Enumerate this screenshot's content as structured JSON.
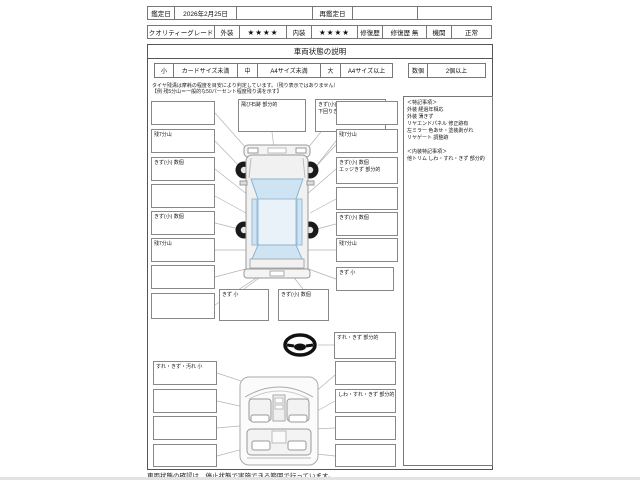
{
  "header": {
    "appraisal_date_label": "鑑定日",
    "appraisal_date": "2026年2月25日",
    "mid_blank": "",
    "reappraisal_date_label": "再鑑定日",
    "reappraisal_date": "",
    "end_blank": "",
    "quality_grade_label": "クオリティーグレード",
    "exterior_label": "外装",
    "exterior_stars": "★★★★",
    "interior_label": "内装",
    "interior_stars": "★★★★",
    "repair_history_label": "修復歴",
    "repair_history_value": "修復歴 無",
    "engine_label": "機関",
    "engine_value": "正常"
  },
  "panel": {
    "title": "車両状態の説明",
    "legend": {
      "small_key": "小",
      "small_val": "カードサイズ未満",
      "medium_key": "中",
      "medium_val": "A4サイズ未満",
      "large_key": "大",
      "large_val": "A4サイズ以上",
      "count_key": "数個",
      "count_val": "2個以上"
    },
    "tire_note_line1": "タイヤ残溝は摩耗の程度を目安により判定しています。（残り表示ではありません）",
    "tire_note_line2": "【例 残5分山＝一般的な50パーセント程度残り溝を示す】"
  },
  "exterior": {
    "left_boxes": [
      "",
      "残7分山",
      "きず(小) 数個",
      "",
      "きず(小) 数個",
      "残7分山",
      "",
      ""
    ],
    "top_boxes": [
      {
        "line1": "飛び石跡 部分的",
        "line2": ""
      },
      {
        "line1": "きず(小) 数個",
        "line2": "下回りきず 部分的"
      }
    ],
    "right_boxes": [
      {
        "line1": "",
        "line2": ""
      },
      {
        "line1": "残7分山",
        "line2": ""
      },
      {
        "line1": "きず(小) 数個",
        "line2": "エッジきず 部分的"
      },
      {
        "line1": "",
        "line2": ""
      },
      {
        "line1": "きず(小) 数個",
        "line2": ""
      },
      {
        "line1": "残7分山",
        "line2": ""
      },
      {
        "line1": "きず 小",
        "line2": ""
      }
    ],
    "bottom_boxes": [
      "きず 小",
      "きず(小) 数個"
    ]
  },
  "interior": {
    "steering_box": "すれ・きず 部分的",
    "left_boxes": [
      "すれ・きず・汚れ 小",
      "",
      "",
      ""
    ],
    "right_boxes": [
      "",
      "しわ・すれ・きず 部分的",
      "",
      ""
    ]
  },
  "remarks": {
    "title1": "＜特記事項＞",
    "ext_line1": "外装 経過年相応",
    "ext_line2": "外装 薄きず",
    "ext_line3": "リヤエンドパネル 修正跡有",
    "ext_line4": "左ミラー 色あせ・塗装剥がれ",
    "ext_line5": "リヤゲート 調整跡",
    "title2": "＜内装特記事項＞",
    "int_line1": "他トリム しわ・すれ・きず 部分的"
  },
  "footer_note": "車両状態の確認は、停止状態で実施できる範囲で行っています。",
  "colors": {
    "glass_blue": "#cfe4f2",
    "roof_blue": "#e9f2f9",
    "body_gray": "#f1f1f1",
    "callout_gray": "#b3b3b3",
    "wheel_black": "#1a1a1a"
  }
}
